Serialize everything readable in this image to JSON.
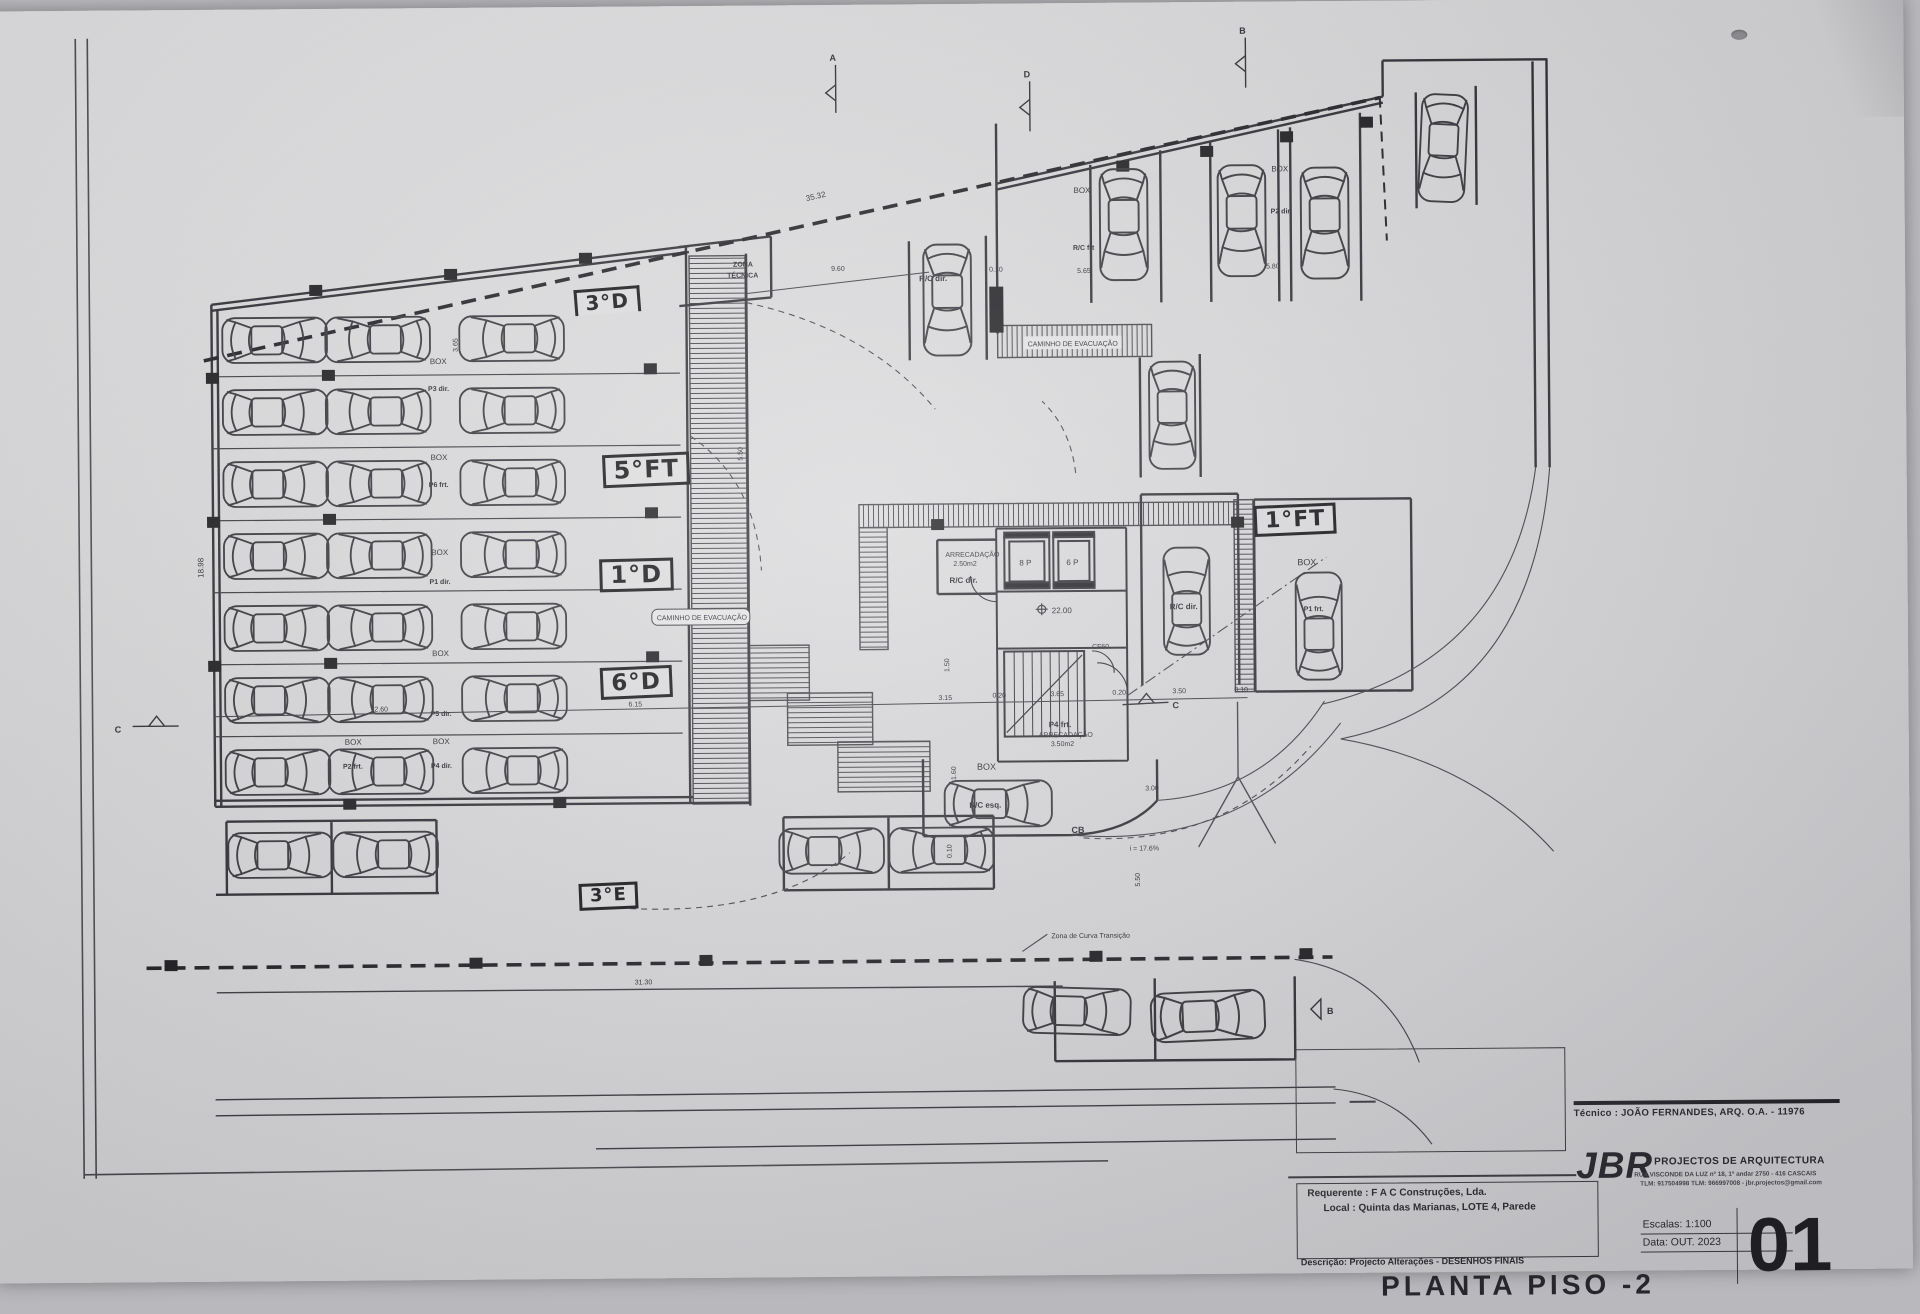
{
  "plan": {
    "handwritten": {
      "h3d": "3°D",
      "h5ft": "5°FT",
      "h1d": "1°D",
      "h6d": "6°D",
      "h3e": "3°E",
      "h1ft": "1°FT"
    },
    "labels": {
      "zona1": "ZONA",
      "zona2": "TÉCNICA",
      "caminho": "CAMINHO DE EVACUAÇÃO",
      "box": "BOX",
      "rc_dir": "R/C dir.",
      "rc_frt": "R/C frt",
      "rc_esq": "R/C esq.",
      "p2_dir": "P2 dir.",
      "p1_frt": "P1 frt.",
      "p4_frt": "P4 frt.",
      "arrecadacao": "ARRECADAÇÃO",
      "area_250": "2.50m2",
      "area_350": "3.50m2",
      "elev_8p": "8 P",
      "elev_6p": "6 P",
      "level": "22.00",
      "cf60": "CF60",
      "slope": "i = 17.6%",
      "curva": "Zona de Curva Transição"
    },
    "parking_rows": [
      {
        "box": "BOX",
        "p": "P3 dir."
      },
      {
        "box": "BOX",
        "p": "P6 frt."
      },
      {
        "box": "BOX",
        "p": "P1 dir."
      },
      {
        "box": "BOX",
        "p": "P5 dir."
      },
      {
        "box": "BOX",
        "p": "P4 dir."
      },
      {
        "box": "BOX",
        "p": "P2 frt."
      }
    ],
    "dims": {
      "top_3532": "35.32",
      "top_960": "9.60",
      "top_010": "0.10",
      "top_565": "5.65",
      "top_580": "5.80",
      "left_1898": "18.98",
      "left_1260": "12.60",
      "mid_615": "6.15",
      "c_315": "3.15",
      "c_020a": "0.20",
      "c_365": "3.65",
      "c_020b": "0.20",
      "c_350": "3.50",
      "c_010": "0.10",
      "bot_3130": "31.30",
      "r_300": "3.00",
      "r_550": "5.50",
      "v_550": "5.50",
      "v_150": "1.50",
      "v_160": "1.60",
      "v_010": "0.10",
      "stall_365": "3.65"
    },
    "markers": {
      "a": "A",
      "d": "D",
      "b_top": "B",
      "c_left": "C",
      "c_right": "C",
      "cb": "CB",
      "b_bottom": "B"
    }
  },
  "title_block": {
    "tecnico": "Técnico : JOÃO FERNANDES, ARQ.   O.A. - 11976",
    "firm": "JBR",
    "firm_tag": "PROJECTOS DE ARQUITECTURA",
    "firm_addr1": "RUA VISCONDE DA LUZ nº 18, 1º andar  2750 - 416  CASCAIS",
    "firm_addr2": "TLM: 917504998 TLM: 966997008 - jbr.projectos@gmail.com",
    "requerente_label": "Requerente :",
    "requerente": "F A C  Construções, Lda.",
    "local_label": "Local :",
    "local": "Quinta das Marianas, LOTE 4, Parede",
    "descricao_label": "Descrição:",
    "descricao": "Projecto Alterações - DESENHOS FINAIS",
    "drawing_title": "PLANTA PISO -2",
    "escalas_label": "Escalas:",
    "escalas": "1:100",
    "data_label": "Data:",
    "data": "OUT. 2023",
    "sheet_number": "01"
  }
}
